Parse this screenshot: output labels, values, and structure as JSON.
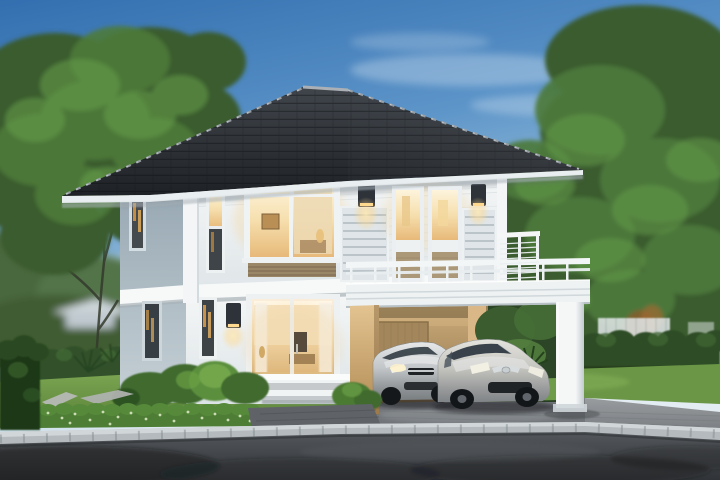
{
  "scene": {
    "type": "exterior-architectural-rendering",
    "time_of_day": "dusk",
    "description": "Two-story modern house with charcoal hip roof and warm lit windows, carport with balcony deck sheltering two silver cars, trimmed hedges, lawn, large trees, paver driveway and asphalt street in the foreground"
  },
  "objects": {
    "house": {
      "label": "two-story house with hip roof",
      "stories": 2,
      "lit_windows": 8,
      "wall_lamps": 3
    },
    "carport": {
      "label": "carport with railing deck above",
      "columns": 2
    },
    "cars": [
      {
        "label": "silver sedan"
      },
      {
        "label": "silver hatchback"
      }
    ],
    "door": {
      "label": "lit glass sliding door with curtains"
    },
    "bench": {
      "label": "white planter bench"
    },
    "vegetation": {
      "left_tree": "large leafy tree",
      "right_trees": "dense tree cluster",
      "hedges": "trimmed hedges",
      "lawn": "green lawn",
      "shrubs": "low speckled shrub row"
    },
    "ground": {
      "driveway": "gray paver driveway",
      "curb": "concrete block curb",
      "road": "asphalt street",
      "walkway": "stepping-stone walkway"
    }
  },
  "palette": {
    "sky_top": "#336fb0",
    "sky_mid": "#5d95c9",
    "sky_pale": "#a9cade",
    "sky_horizon": "#e2ecf2",
    "cloud_white": "#ffffff",
    "foliage_dark": "#3a5c2f",
    "foliage_mid": "#4d7a3b",
    "foliage_light": "#68a04a",
    "foliage_accent": "#86b757",
    "trunk_brown": "#343a2b",
    "hedge_dark": "#2f4d27",
    "hedge_block": "#1e3718",
    "hedge_speckle": "#d8e6c2",
    "lawn_light": "#7aa450",
    "lawn_dark": "#577f38",
    "lawn_back": "#6a9646",
    "roof_dark_top": "#41464c",
    "roof_dark_bottom": "#1e2125",
    "roof_ridge": "#9aa1a7",
    "fascia_white": "#e9eef0",
    "wall_front_top": "#f4f6f6",
    "wall_front_bottom": "#dde4e7",
    "wall_side_top": "#98a8b3",
    "wall_side_bottom": "#c6d1d6",
    "band_white": "#f7f9f9",
    "pilaster_white": "#f3f5f6",
    "frame_white": "#eef1f2",
    "glass_dark": "#3e4347",
    "warm_top": "#fdf4dc",
    "warm_mid": "#f6dfae",
    "warm_deep": "#e7b979",
    "lamp_glow": "#ffd98f",
    "lamp_body": "#2e333a",
    "louver_white": "#dfe5e8",
    "louver_line": "#b7c1c6",
    "spandrel_tan": "#9a8767",
    "carport_tan_top": "#cfae7c",
    "carport_tan_bottom": "#8a7048",
    "pillar_tan_top": "#e3c491",
    "pillar_tan_bottom": "#b08953",
    "slab_white": "#eef2f3",
    "column_white": "#f5f7f7",
    "column_shade": "#c3cbd0",
    "car_glass": "#3a434b",
    "car_silver_hi": "#e6e8e9",
    "car_silver_lo": "#7a7f82",
    "car_trim_dark": "#202326",
    "chrome": "#d7dcde",
    "driveway_light": "#9a9ea1",
    "driveway_dark": "#7b7f83",
    "curb_light": "#d3d8da",
    "curb_mid": "#b4babd",
    "road_top": "#53575b",
    "road_bottom": "#303337",
    "shadow_dark": "#17191c",
    "stone_walk": "#b6b9b5",
    "apron_gray": "#5f6367",
    "bench_white": "#f1f4f5",
    "fence_white": "#e3e8ea",
    "accent_rust": "#8a5a2c"
  }
}
